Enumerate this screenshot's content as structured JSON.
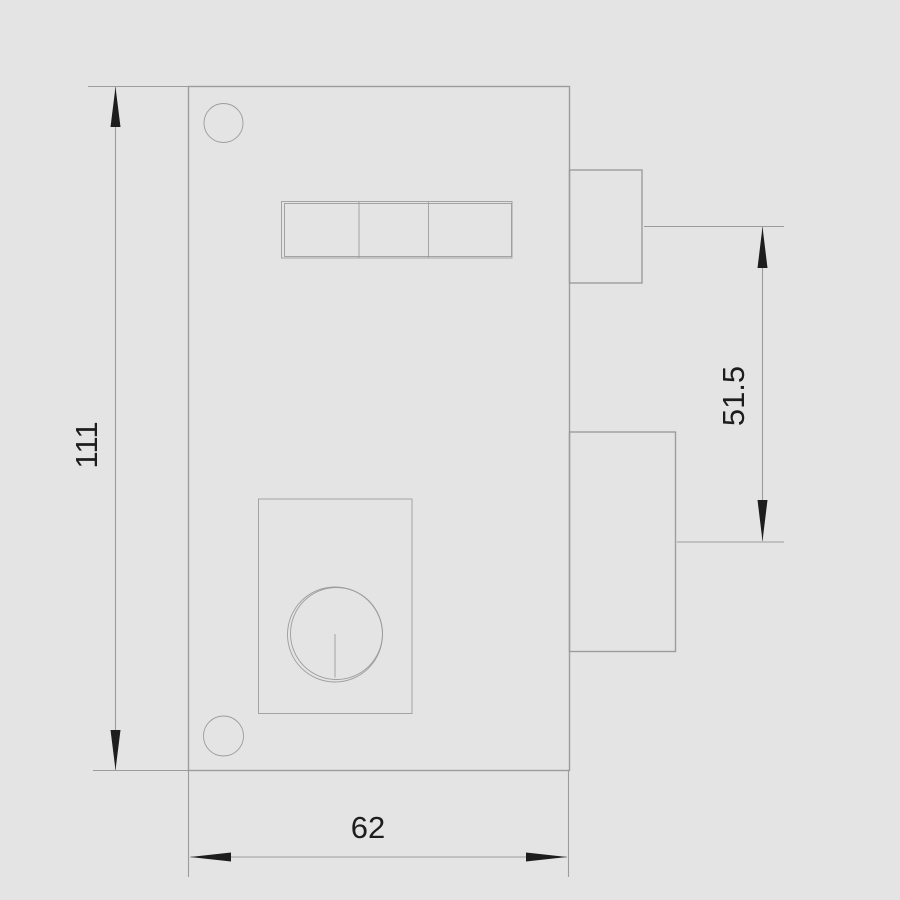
{
  "colors": {
    "background": "#e4e4e4",
    "line": "#9c9c9c",
    "ink": "#1d1d1d"
  },
  "dimensions": {
    "height_label": "111",
    "offset_label": "51.5",
    "width_label": "62"
  }
}
